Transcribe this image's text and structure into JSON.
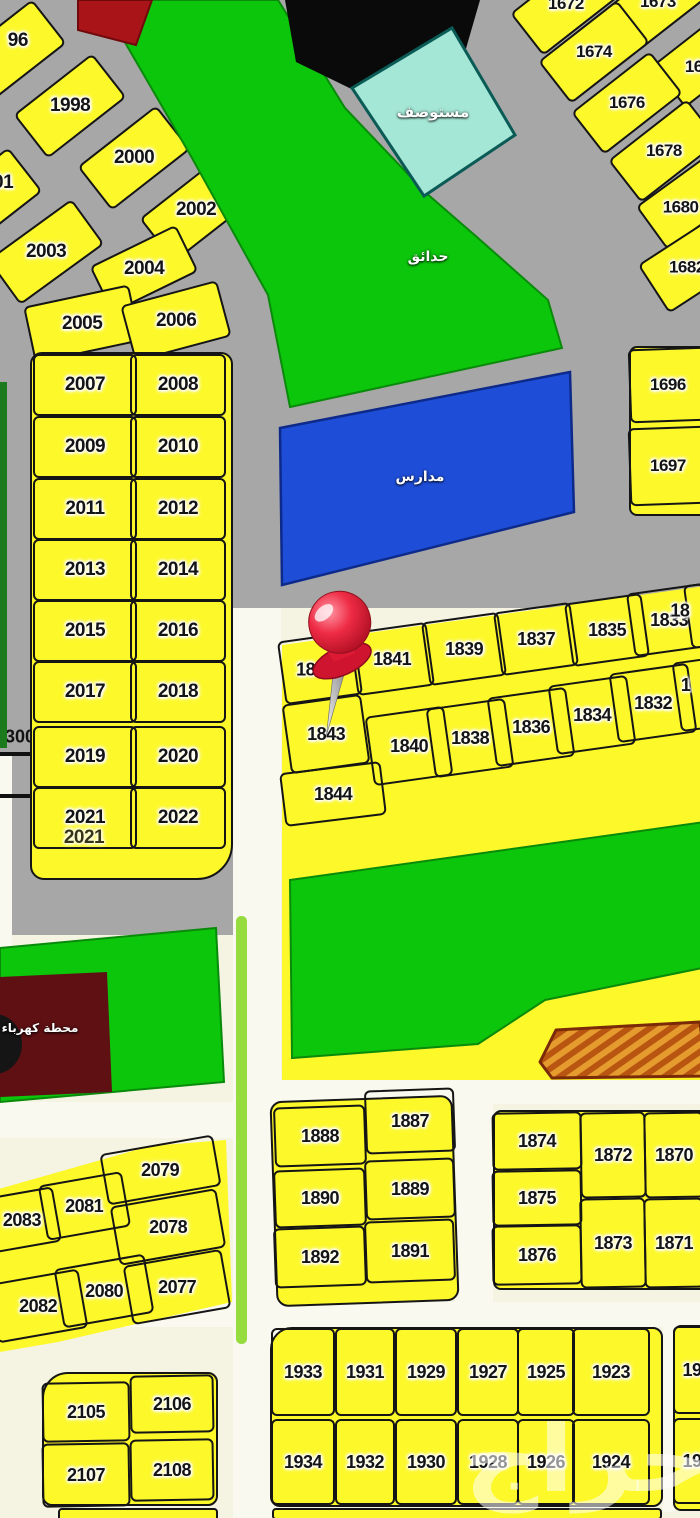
{
  "map": {
    "region_labels": {
      "park": "حدائق",
      "schools": "مدارس",
      "clinic": "مستوصف",
      "power_station": "محطة كهرباء"
    },
    "street_marker": "300",
    "watermark": "حراج",
    "colors": {
      "road_gray": "#a7a7a7",
      "plot_yellow": "#fcf82a",
      "park_green": "#0cc60c",
      "schools_blue": "#1e4ed8",
      "clinic_teal": "#a5e7d6",
      "building_black": "#0a0a0a",
      "building_dark_red": "#a81418",
      "power_station_maroon": "#5e1013",
      "hatch_dark": "#b85511",
      "hatch_light": "#e59b2d",
      "street_white": "#faf9ef",
      "ground_pale": "#f5f4e2",
      "divider_green_line": "#97dc3f",
      "pin_red": "#ee2b44"
    },
    "blocks": [
      {
        "name": "top-left-strip",
        "r": -38,
        "w": 100,
        "h": 56,
        "fill": true,
        "fs": 19,
        "cells": [
          {
            "n": "96",
            "x": 10,
            "y": 52,
            "ox": 13,
            "oy": -4
          },
          {
            "n": "1998",
            "x": 70,
            "y": 106
          },
          {
            "n": "2000",
            "x": 134,
            "y": 158
          },
          {
            "n": "2002",
            "x": 196,
            "y": 210
          },
          {
            "n": "01",
            "x": -14,
            "y": 200,
            "ox": 24,
            "oy": -3
          },
          {
            "n": "2003",
            "x": 46,
            "y": 252,
            "r": -36,
            "w": 104
          },
          {
            "n": "2004",
            "x": 144,
            "y": 269,
            "r": -26,
            "w": 96,
            "h": 52
          },
          {
            "n": "2005",
            "x": 82,
            "y": 324,
            "r": -12,
            "w": 108,
            "h": 58
          },
          {
            "n": "2006",
            "x": 176,
            "y": 321,
            "r": -15,
            "w": 100,
            "h": 58
          }
        ]
      },
      {
        "name": "west-column",
        "r": 0,
        "w": 104,
        "h": 62,
        "fill": false,
        "fs": 19,
        "bg": {
          "x": 30,
          "y": 352,
          "w": 203,
          "h": 528,
          "radius": "12px 12px 36px 14px"
        },
        "cells": [
          {
            "n": "2007",
            "x": 85,
            "y": 385
          },
          {
            "n": "2008",
            "x": 178,
            "y": 385,
            "w": 96
          },
          {
            "n": "2009",
            "x": 85,
            "y": 447
          },
          {
            "n": "2010",
            "x": 178,
            "y": 447,
            "w": 96
          },
          {
            "n": "2011",
            "x": 85,
            "y": 509
          },
          {
            "n": "2012",
            "x": 178,
            "y": 509,
            "w": 96
          },
          {
            "n": "2013",
            "x": 85,
            "y": 570
          },
          {
            "n": "2014",
            "x": 178,
            "y": 570,
            "w": 96
          },
          {
            "n": "2015",
            "x": 85,
            "y": 631
          },
          {
            "n": "2016",
            "x": 178,
            "y": 631,
            "w": 96
          },
          {
            "n": "2017",
            "x": 85,
            "y": 692
          },
          {
            "n": "2018",
            "x": 178,
            "y": 692,
            "w": 96
          },
          {
            "n": "2019",
            "x": 85,
            "y": 757
          },
          {
            "n": "2020",
            "x": 178,
            "y": 757,
            "w": 96
          },
          {
            "n": "2021",
            "x": 85,
            "y": 818
          },
          {
            "n": "2022",
            "x": 178,
            "y": 818,
            "w": 96
          },
          {
            "n": "2021",
            "x": 84,
            "y": 838,
            "ghost": true
          }
        ]
      },
      {
        "name": "northeast-strip",
        "r": -38,
        "w": 100,
        "h": 54,
        "fill": true,
        "fs": 17,
        "cells": [
          {
            "n": "1672",
            "x": 566,
            "y": 4
          },
          {
            "n": "1673",
            "x": 658,
            "y": 2
          },
          {
            "n": "1674",
            "x": 594,
            "y": 52
          },
          {
            "n": "16",
            "x": 708,
            "y": 56,
            "ox": -18
          },
          {
            "n": "1676",
            "x": 627,
            "y": 103
          },
          {
            "n": "1678",
            "x": 664,
            "y": 151
          },
          {
            "n": "1680",
            "x": 692,
            "y": 199,
            "r": -36,
            "ox": -14
          },
          {
            "n": "1682",
            "x": 697,
            "y": 261,
            "r": -33,
            "w": 104,
            "h": 58,
            "ox": -12
          }
        ]
      },
      {
        "name": "east-block",
        "r": -2,
        "w": 78,
        "h": 74,
        "fill": false,
        "fs": 17,
        "bg": {
          "x": 629,
          "y": 346,
          "w": 82,
          "h": 170,
          "radius": "8px"
        },
        "cells": [
          {
            "n": "1696",
            "x": 668,
            "y": 385
          },
          {
            "n": "1697",
            "x": 668,
            "y": 466,
            "h": 78
          }
        ]
      },
      {
        "name": "pin-block",
        "r": -8,
        "w": 78,
        "h": 64,
        "fill": false,
        "fs": 18,
        "poly": "282px 645px, 712px 585px, 712px 1080px, 282px 1080px",
        "cells": [
          {
            "n": "184",
            "x": 320,
            "y": 668,
            "ox": -10
          },
          {
            "n": "1841",
            "x": 392,
            "y": 659
          },
          {
            "n": "1839",
            "x": 464,
            "y": 649
          },
          {
            "n": "1837",
            "x": 536,
            "y": 639
          },
          {
            "n": "1835",
            "x": 607,
            "y": 630
          },
          {
            "n": "1833",
            "x": 669,
            "y": 620
          },
          {
            "n": "18",
            "x": 726,
            "y": 612,
            "ox": -45,
            "oy": -8
          },
          {
            "n": "1843",
            "x": 326,
            "y": 734,
            "w": 80,
            "h": 70
          },
          {
            "n": "1840",
            "x": 409,
            "y": 746,
            "w": 80,
            "h": 70
          },
          {
            "n": "1838",
            "x": 470,
            "y": 738,
            "w": 80,
            "h": 70
          },
          {
            "n": "1836",
            "x": 531,
            "y": 727,
            "w": 80,
            "h": 70
          },
          {
            "n": "1834",
            "x": 592,
            "y": 715,
            "w": 80,
            "h": 70
          },
          {
            "n": "1832",
            "x": 653,
            "y": 703,
            "w": 80,
            "h": 70
          },
          {
            "n": "1",
            "x": 716,
            "y": 692,
            "w": 80,
            "h": 70,
            "ox": -29,
            "oy": -11
          },
          {
            "n": "1844",
            "x": 333,
            "y": 794,
            "w": 102,
            "h": 54,
            "r": -7
          }
        ]
      },
      {
        "name": "south-center-block",
        "r": -2,
        "w": 92,
        "h": 60,
        "fill": false,
        "fs": 18,
        "bg": {
          "x": 273,
          "y": 1098,
          "w": 183,
          "h": 206,
          "radius": "12px",
          "rot": -2
        },
        "cells": [
          {
            "n": "1888",
            "x": 320,
            "y": 1136
          },
          {
            "n": "1887",
            "x": 410,
            "y": 1121,
            "w": 90,
            "h": 64
          },
          {
            "n": "1890",
            "x": 320,
            "y": 1198,
            "h": 58
          },
          {
            "n": "1889",
            "x": 410,
            "y": 1189,
            "w": 90
          },
          {
            "n": "1892",
            "x": 320,
            "y": 1257
          },
          {
            "n": "1891",
            "x": 410,
            "y": 1251,
            "w": 90,
            "h": 62
          }
        ]
      },
      {
        "name": "southeast-block",
        "r": -1,
        "w": 90,
        "h": 58,
        "fill": false,
        "fs": 18,
        "bg": {
          "x": 493,
          "y": 1110,
          "w": 215,
          "h": 180,
          "radius": "8px"
        },
        "cells": [
          {
            "n": "1874",
            "x": 537,
            "y": 1141
          },
          {
            "n": "1875",
            "x": 537,
            "y": 1198,
            "h": 56
          },
          {
            "n": "1876",
            "x": 537,
            "y": 1255,
            "h": 60
          },
          {
            "n": "1872",
            "x": 613,
            "y": 1155,
            "w": 66,
            "h": 86
          },
          {
            "n": "1873",
            "x": 613,
            "y": 1243,
            "w": 66,
            "h": 90
          },
          {
            "n": "1870",
            "x": 674,
            "y": 1155,
            "w": 60,
            "h": 86
          },
          {
            "n": "1871",
            "x": 674,
            "y": 1243,
            "w": 60,
            "h": 90
          }
        ]
      },
      {
        "name": "southwest-tilted-block",
        "r": -10,
        "w": 92,
        "h": 58,
        "fill": false,
        "fs": 18,
        "poly": "-12px 1192px, 150px 1146px, 226px 1140px, 232px 1302px, 58px 1342px, -12px 1354px",
        "cells": [
          {
            "n": "2079",
            "x": 160,
            "y": 1170,
            "w": 115,
            "h": 52
          },
          {
            "n": "2081",
            "x": 84,
            "y": 1206,
            "w": 85,
            "h": 56
          },
          {
            "n": "2083",
            "x": 10,
            "y": 1222,
            "w": 95,
            "h": 56,
            "ox": 12
          },
          {
            "n": "2078",
            "x": 168,
            "y": 1227,
            "w": 108,
            "h": 60
          },
          {
            "n": "2080",
            "x": 104,
            "y": 1291,
            "h": 60
          },
          {
            "n": "2082",
            "x": 38,
            "y": 1306,
            "h": 60
          },
          {
            "n": "2077",
            "x": 177,
            "y": 1287,
            "w": 100,
            "h": 60
          }
        ]
      },
      {
        "name": "southwest-block",
        "r": -1,
        "w": 88,
        "h": 60,
        "fill": false,
        "fs": 18,
        "bg": {
          "x": 42,
          "y": 1372,
          "w": 176,
          "h": 134,
          "radius": "26px 10px 10px 10px"
        },
        "bg2": {
          "x": 58,
          "y": 1508,
          "w": 160,
          "h": 14,
          "radius": "4px"
        },
        "cells": [
          {
            "n": "2105",
            "x": 86,
            "y": 1412
          },
          {
            "n": "2106",
            "x": 172,
            "y": 1404,
            "w": 84,
            "h": 58
          },
          {
            "n": "2107",
            "x": 86,
            "y": 1475,
            "h": 64
          },
          {
            "n": "2108",
            "x": 172,
            "y": 1470,
            "w": 84,
            "h": 62
          }
        ]
      },
      {
        "name": "south-block",
        "r": 0,
        "w": 62,
        "h": 88,
        "fill": false,
        "fs": 18,
        "bg": {
          "x": 270,
          "y": 1327,
          "w": 393,
          "h": 180,
          "radius": "22px 10px 10px 10px"
        },
        "bg2": {
          "x": 272,
          "y": 1508,
          "w": 390,
          "h": 12,
          "radius": "4px"
        },
        "cells": [
          {
            "n": "1933",
            "x": 303,
            "y": 1372,
            "w": 64
          },
          {
            "n": "1931",
            "x": 365,
            "y": 1372,
            "w": 60
          },
          {
            "n": "1929",
            "x": 426,
            "y": 1372
          },
          {
            "n": "1927",
            "x": 488,
            "y": 1372
          },
          {
            "n": "1925",
            "x": 546,
            "y": 1372,
            "w": 58
          },
          {
            "n": "1923",
            "x": 611,
            "y": 1372,
            "w": 78
          },
          {
            "n": "1934",
            "x": 303,
            "y": 1462,
            "w": 64,
            "h": 86
          },
          {
            "n": "1932",
            "x": 365,
            "y": 1462,
            "w": 60,
            "h": 86
          },
          {
            "n": "1930",
            "x": 426,
            "y": 1462,
            "h": 86
          },
          {
            "n": "1928",
            "x": 488,
            "y": 1462,
            "h": 86
          },
          {
            "n": "1926",
            "x": 546,
            "y": 1462,
            "w": 58,
            "h": 86
          },
          {
            "n": "1924",
            "x": 611,
            "y": 1462,
            "w": 78,
            "h": 86
          }
        ]
      },
      {
        "name": "south-edge-block",
        "r": 0,
        "w": 52,
        "h": 88,
        "fill": false,
        "fs": 18,
        "bg": {
          "x": 673,
          "y": 1325,
          "w": 45,
          "h": 186,
          "radius": "8px"
        },
        "cells": [
          {
            "n": "19",
            "x": 699,
            "y": 1370,
            "ox": -7
          },
          {
            "n": "19",
            "x": 699,
            "y": 1461,
            "h": 86,
            "ox": -7
          }
        ]
      }
    ]
  }
}
